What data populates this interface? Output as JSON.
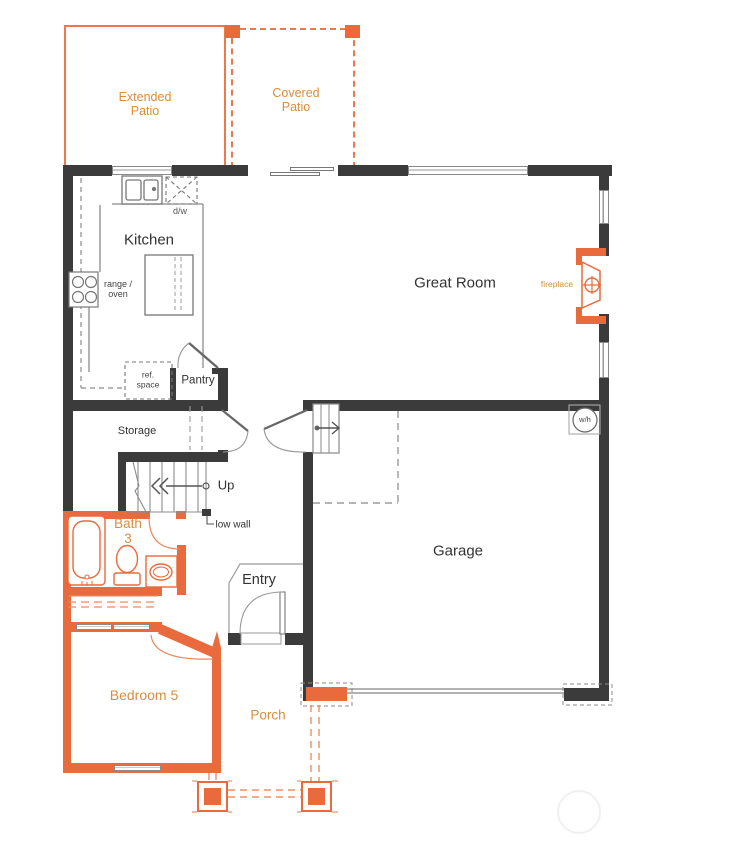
{
  "colors": {
    "wall": "#3B3B3B",
    "orange": "#E96A3C",
    "label_orange": "#D98D3E",
    "line": "#8C8C8C",
    "lightline": "#AFAFAF",
    "text": "#333333"
  },
  "labels": {
    "extended_patio_1": "Extended",
    "extended_patio_2": "Patio",
    "covered_patio_1": "Covered",
    "covered_patio_2": "Patio",
    "kitchen": "Kitchen",
    "dw": "d/w",
    "range_1": "range /",
    "range_2": "oven",
    "ref_1": "ref.",
    "ref_2": "space",
    "pantry": "Pantry",
    "great_room": "Great Room",
    "fireplace": "fireplace",
    "storage": "Storage",
    "up": "Up",
    "low_wall": "low wall",
    "bath_1": "Bath",
    "bath_2": "3",
    "entry": "Entry",
    "garage": "Garage",
    "wh": "w/h",
    "bedroom5": "Bedroom 5",
    "porch": "Porch"
  }
}
